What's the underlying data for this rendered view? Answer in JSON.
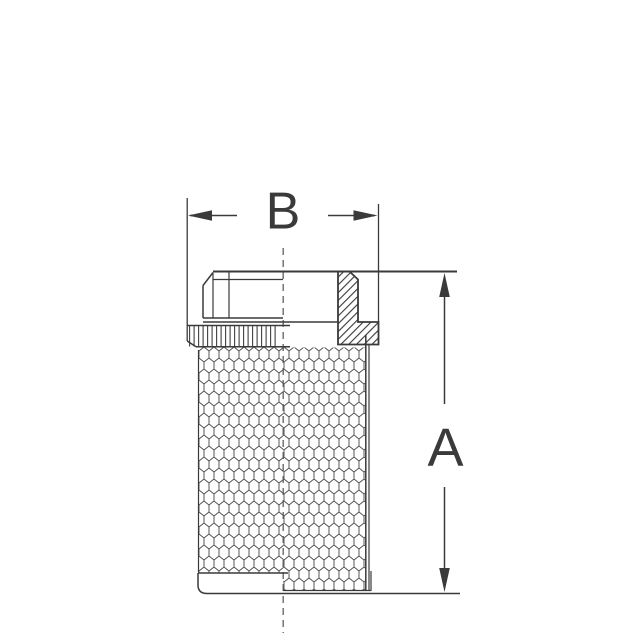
{
  "drawing": {
    "kind": "half-section technical drawing of a threaded mesh strainer fitting",
    "dimensions": {
      "height_label": "A",
      "width_label": "B"
    },
    "colors": {
      "background": "#ffffff",
      "line": "#3a3a3a",
      "mesh_line": "#4f4f4f",
      "knurl_line": "#3f3f3f",
      "centerline": "#6a6a6a",
      "label_text": "#3a3a3a"
    }
  }
}
